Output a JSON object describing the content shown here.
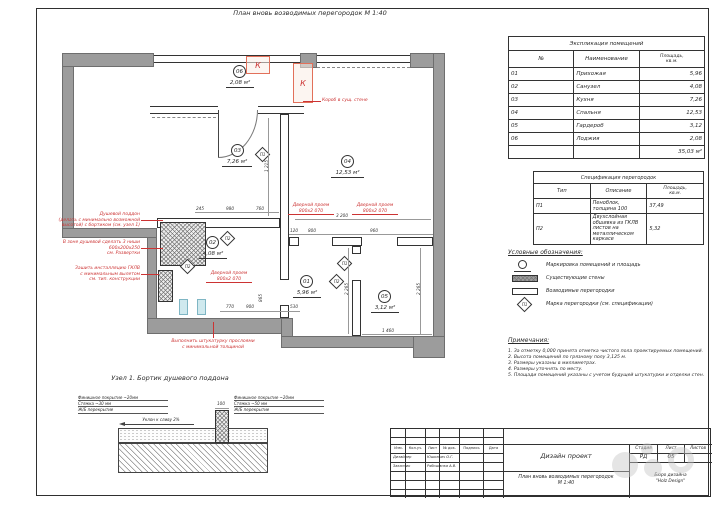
{
  "colors": {
    "wall": "#9c9c9c",
    "accent_red": "#cc3333",
    "line": "#333333"
  },
  "page": {
    "title": "План вновь возводимых перегородок М 1:40"
  },
  "plan": {
    "rooms": [
      {
        "num": "01",
        "area": "5,96 м²"
      },
      {
        "num": "02",
        "area": "4,08 м²"
      },
      {
        "num": "03",
        "area": "7,26 м²"
      },
      {
        "num": "04",
        "area": "12,53 м²"
      },
      {
        "num": "05",
        "area": "3,12 м²"
      },
      {
        "num": "06",
        "area": "2,08 м²"
      }
    ],
    "marks": [
      {
        "label": "П1"
      },
      {
        "label": "П2"
      },
      {
        "label": "П1"
      },
      {
        "label": "П2"
      },
      {
        "label": "П2"
      }
    ],
    "k_unit": "К",
    "door_label": "Дверной проем 800х2 070",
    "annotations": {
      "shower_tray": [
        "Душевой поддон",
        "(делать с минимально возможной",
        "высотой) с бортиком (см. узел 1)"
      ],
      "niches": [
        "В зоне душевой сделать 3 ниши",
        "600х200х250",
        "см. Развертки"
      ],
      "installation": [
        "Зашить инсталляцию ГКЛВ",
        "с минимальным вылетом",
        "см. тип. конструкции"
      ],
      "plaster": [
        "Выполнить штукатурку прослоями",
        "с минимальной толщиной"
      ],
      "duct": "Короб в сущ. стене"
    },
    "dims": [
      "1 215",
      "3 200",
      "2 265",
      "2 265",
      "1 460",
      "800",
      "960",
      "120",
      "245",
      "980",
      "760",
      "770",
      "900",
      "530",
      "865"
    ]
  },
  "detail": {
    "title": "Узел 1. Бортик душевого поддона",
    "left_note": [
      "Финишное покрытие ~20мм",
      "Стяжка ~30 мм",
      "Ж/Б перекрытие"
    ],
    "right_note": [
      "Финишное покрытие ~20мм",
      "Стяжка ~50 мм",
      "Ж/Б перекрытие"
    ],
    "slope": "Уклон к сливу 2%",
    "curb_width": "100"
  },
  "explication": {
    "title": "Экспликация помещений",
    "col_num": "№",
    "col_name": "Наименование",
    "col_area_l1": "Площадь,",
    "col_area_l2": "кв.м.",
    "rows": [
      {
        "num": "01",
        "name": "Прихожая",
        "area": "5,96"
      },
      {
        "num": "02",
        "name": "Санузел",
        "area": "4,08"
      },
      {
        "num": "03",
        "name": "Кухня",
        "area": "7,26"
      },
      {
        "num": "04",
        "name": "Спальня",
        "area": "12,53"
      },
      {
        "num": "05",
        "name": "Гардероб",
        "area": "3,12"
      },
      {
        "num": "06",
        "name": "Лоджия",
        "area": "2,08"
      }
    ],
    "total": "35,03 м²"
  },
  "specification": {
    "title": "Спецификация перегородок",
    "col_type": "Тип",
    "col_desc": "Описание",
    "col_area_l1": "Площадь,",
    "col_area_l2": "кв.м.",
    "rows": [
      {
        "type": "П1",
        "desc": "Пеноблок, толщина 100",
        "area": "37,49"
      },
      {
        "type": "П2",
        "desc": "Двухслойная обшивка из ГКЛВ листов на металлическом каркасе",
        "area": "5,32"
      }
    ]
  },
  "legend": {
    "title": "Условные обозначения:",
    "mark_sample": "П1",
    "items": [
      "Маркировка помещений и площадь",
      "Существующие стены",
      "Возводимые перегородки",
      "Марка перегородки (см. спецификации)"
    ]
  },
  "notes": {
    "title": "Примечания:",
    "items": [
      "1. За отметку 0,000 принята отметка чистого пола проектируемых помещений.",
      "2. Высота помещений по грязному полу 3,125 м.",
      "3. Размеры указаны в миллиметрах.",
      "4. Размеры уточнять по месту.",
      "5. Площади помещений указаны с учетом будущей штукатурки и отделки стен."
    ]
  },
  "titleblock": {
    "cols": [
      "Изм.",
      "Кол.уч.",
      "Лист",
      "№ док.",
      "Подпись",
      "Дата"
    ],
    "row1_role": "Дизайнер",
    "row1_name": "Юшкевич О.Г.",
    "row2_role": "Заказчик",
    "row2_name": "Рябошапка А.В.",
    "project": "Дизайн проект",
    "stage_label": "Стадия",
    "sheet_label": "Лист",
    "sheets_label": "Листов",
    "stage": "РД",
    "sheet_num": "05",
    "drawing_title": "План вновь возводимых перегородок",
    "drawing_scale": "М 1:40",
    "company_l1": "Бюро дизайна",
    "company_l2": "\"Holz Design\""
  }
}
